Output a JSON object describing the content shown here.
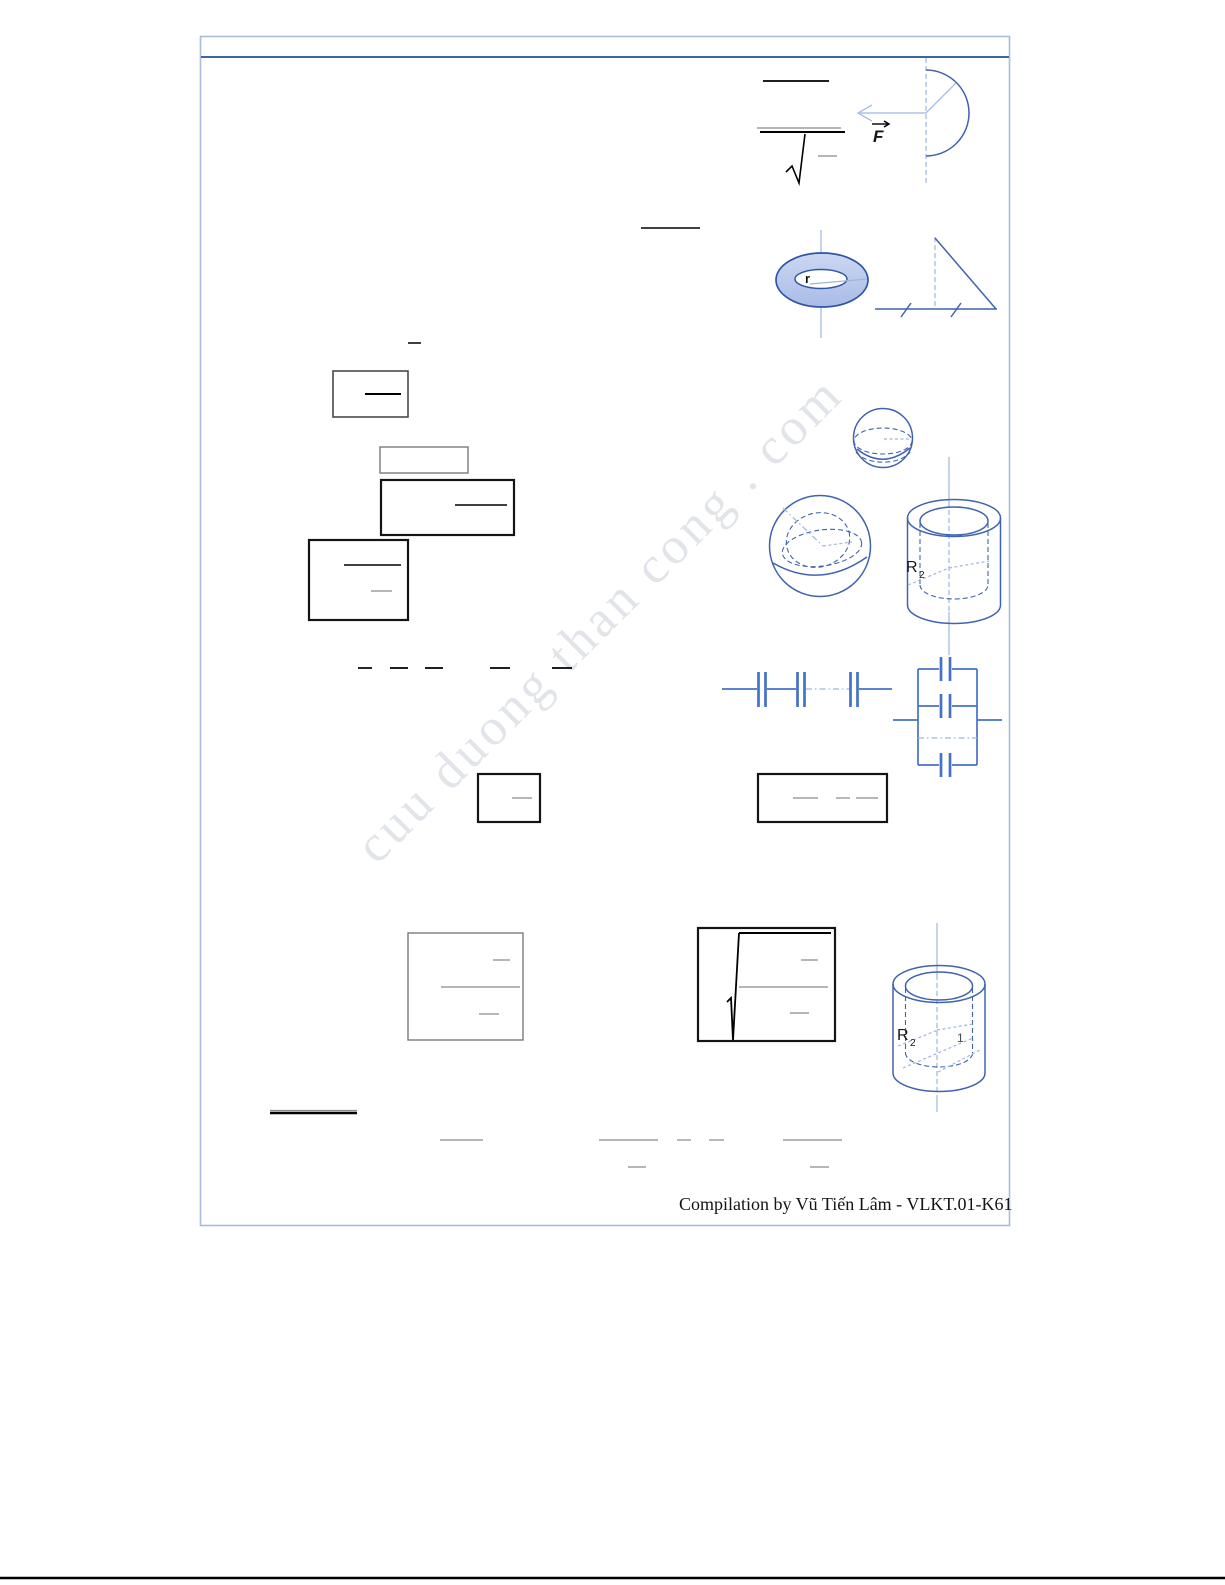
{
  "page": {
    "footer_credit": "Compilation by Vũ Tiến Lâm - VLKT.01-K61",
    "watermark": "cuu duong than cong . com"
  },
  "labels": {
    "force_vector": "F",
    "torus_inner_radius": "r",
    "cylinder_top_radius_main": "R",
    "cylinder_top_radius_sub": "2",
    "cylinder_bottom_radius_main": "R",
    "cylinder_bottom_radius_sub": "2",
    "cylinder_bottom_inner_mark": "1"
  },
  "colors": {
    "figure_blue": "#3f63b0",
    "light_blue": "#9db6e0",
    "capacitor_blue": "#4472c4",
    "torus_fill": "#a9bbe6",
    "torus_fill_light": "#ccd7f2",
    "page_border": "#a9bcd9",
    "header_rule": "#3a64ac",
    "formula_gray": "#8a8a8a",
    "ink_black": "#000000",
    "watermark_gray": "#c9ced8"
  }
}
